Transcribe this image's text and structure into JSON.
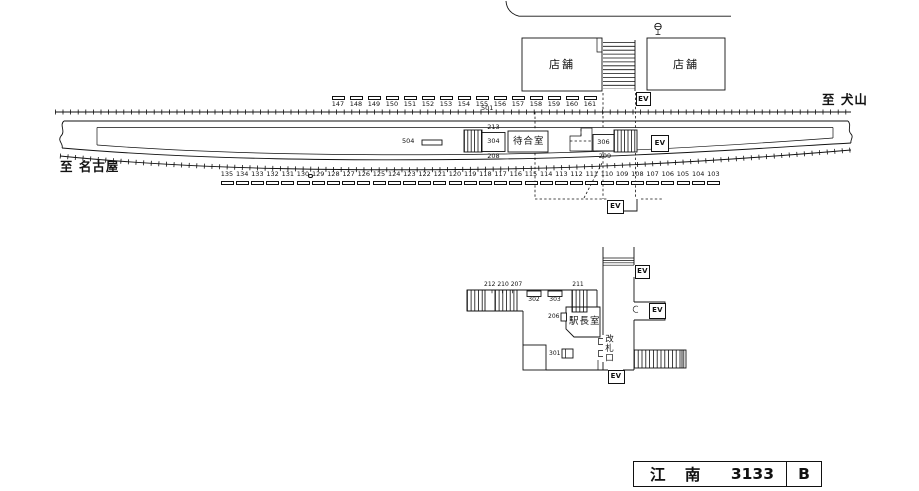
{
  "labels": {
    "ev": "EV",
    "shop_left": "店舗",
    "shop_right": "店舗",
    "to_inuyama": "至 犬山",
    "to_nagoya": "至 名古屋",
    "waiting_room": "待合室",
    "stationmaster_room": "駅長室",
    "ticket_gate": "改札口",
    "n501": "501",
    "n504": "504",
    "n213": "213",
    "n304": "304",
    "n208": "208",
    "n306": "306",
    "n209": "209",
    "cluster_212_210_207": "212 210 207",
    "n302": "302",
    "n303": "303",
    "n211": "211",
    "n206": "206",
    "n301": "301"
  },
  "title_box": {
    "station": "江 南",
    "number": "3133",
    "code": "B"
  },
  "marker_rows": {
    "top": {
      "values": [
        "147",
        "148",
        "149",
        "150",
        "151",
        "152",
        "153",
        "154",
        "155",
        "156",
        "157",
        "158",
        "159",
        "160",
        "161"
      ]
    },
    "bottom": {
      "values": [
        "135",
        "134",
        "133",
        "132",
        "131",
        "130",
        "129",
        "128",
        "127",
        "126",
        "125",
        "124",
        "123",
        "122",
        "121",
        "120",
        "119",
        "118",
        "117",
        "116",
        "115",
        "114",
        "113",
        "112",
        "111",
        "110",
        "109",
        "108",
        "107",
        "106",
        "105",
        "104",
        "103"
      ],
      "separator": {
        "after": "130",
        "symbol": "○"
      }
    }
  },
  "colors": {
    "ink": "#111111",
    "background": "#ffffff"
  }
}
